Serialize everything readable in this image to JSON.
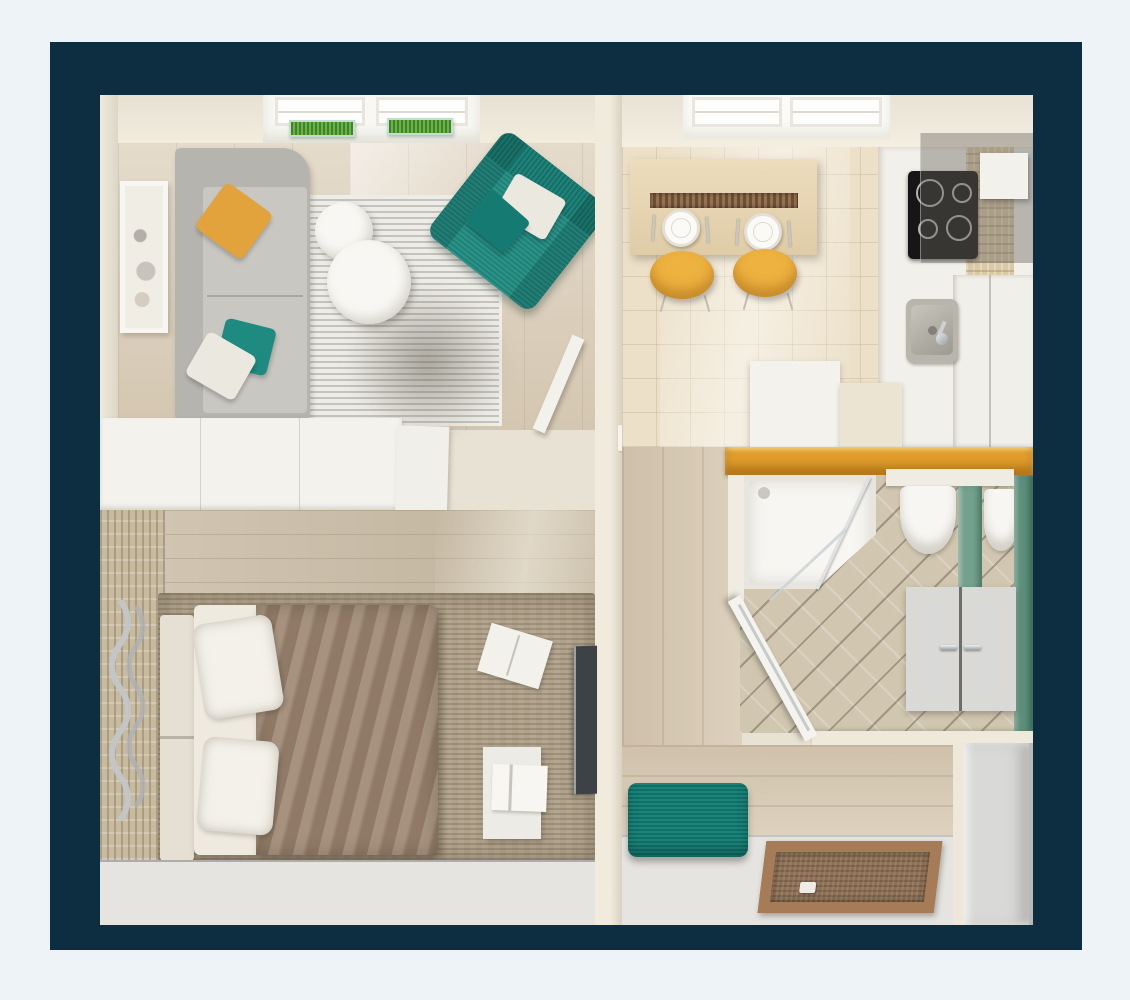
{
  "meta": {
    "description": "Photorealistic top-down 3D render of a one-bedroom apartment floor plan inside a dark navy mat frame",
    "view": "top-down-3d-floor-plan"
  },
  "palette": {
    "backdrop": "#eef3f8",
    "frame_navy": "#0d2d40",
    "wall_cream": "#ece6d9",
    "wood_living": "#dccfba",
    "wood_bedroom": "#cabda7",
    "wood_hall": "#d9ccb6",
    "parquet": "#ece0c8",
    "sofa_gray": "#b6b4af",
    "pillow_orange": "#e2a33c",
    "teal": "#1f8a80",
    "teal_dark": "#157a71",
    "pillow_white": "#ebe8e0",
    "plant_green": "#55a231",
    "chair_yellow": "#eeb240",
    "table_runner": "#6e4e33",
    "cooktop_black": "#161616",
    "counter_gold": "#e09e2c",
    "glass_green": "#74a18d",
    "wall_green": "#5d8f7c",
    "bench_teal": "#0f7a70",
    "mat_wood": "#a57b58",
    "mat_inner": "#8e7053",
    "door_gray": "#d9d9d7",
    "stone_wall": "#c7ba9f",
    "rug_brown": "#b0a28a",
    "blanket_taupe": "#9d8671",
    "bed_cream": "#efeadf",
    "headboard_cream": "#e6e0d4",
    "tv_dark": "#3d4247",
    "floor_white": "#e5e4e0"
  },
  "scene": {
    "rooms": [
      {
        "name": "living-room",
        "items": [
          "corner-sofa",
          "orange-accent-pillow",
          "teal-accent-pillow",
          "white-accent-pillow",
          "round-nesting-tables x2",
          "teal-armchair",
          "armchair-pillows x2",
          "striped-area-rug",
          "framed-wall-art",
          "skylight-windows x2",
          "grass-planter-boxes x2",
          "leaning-panel"
        ]
      },
      {
        "name": "bedroom",
        "items": [
          "double-bed",
          "white-pillows x2",
          "taupe-blanket",
          "upholstered-headboard",
          "woven-area-rug",
          "stone-accent-wall",
          "silver-wavy-wall-decor",
          "wall-mounted-tv",
          "foot-bench",
          "storage-box",
          "magazine-on-rug"
        ]
      },
      {
        "name": "kitchen",
        "items": [
          "wood-dining-table",
          "dark-table-runner",
          "place-settings x2",
          "yellow-chairs x2",
          "black-cooktop-4-burners",
          "range-hood",
          "stainless-sink",
          "fridge-cabinet",
          "white-counter",
          "mosaic-backsplash",
          "skylight-windows x2"
        ]
      },
      {
        "name": "bathroom",
        "items": [
          "corner-shower",
          "glass-shower-door",
          "wall-hung-toilet",
          "wall-hung-bidet",
          "green-glass-partition",
          "green-accent-wall",
          "double-door-vanity-cabinet",
          "gold-counter-ledge",
          "open-white-door",
          "textured-tile-floor"
        ]
      },
      {
        "name": "entry-hall",
        "items": [
          "teal-ottoman-bench",
          "wood-framed-floor-mat",
          "entry-door",
          "wardrobe-unit",
          "wood-plank-floor"
        ]
      }
    ]
  }
}
